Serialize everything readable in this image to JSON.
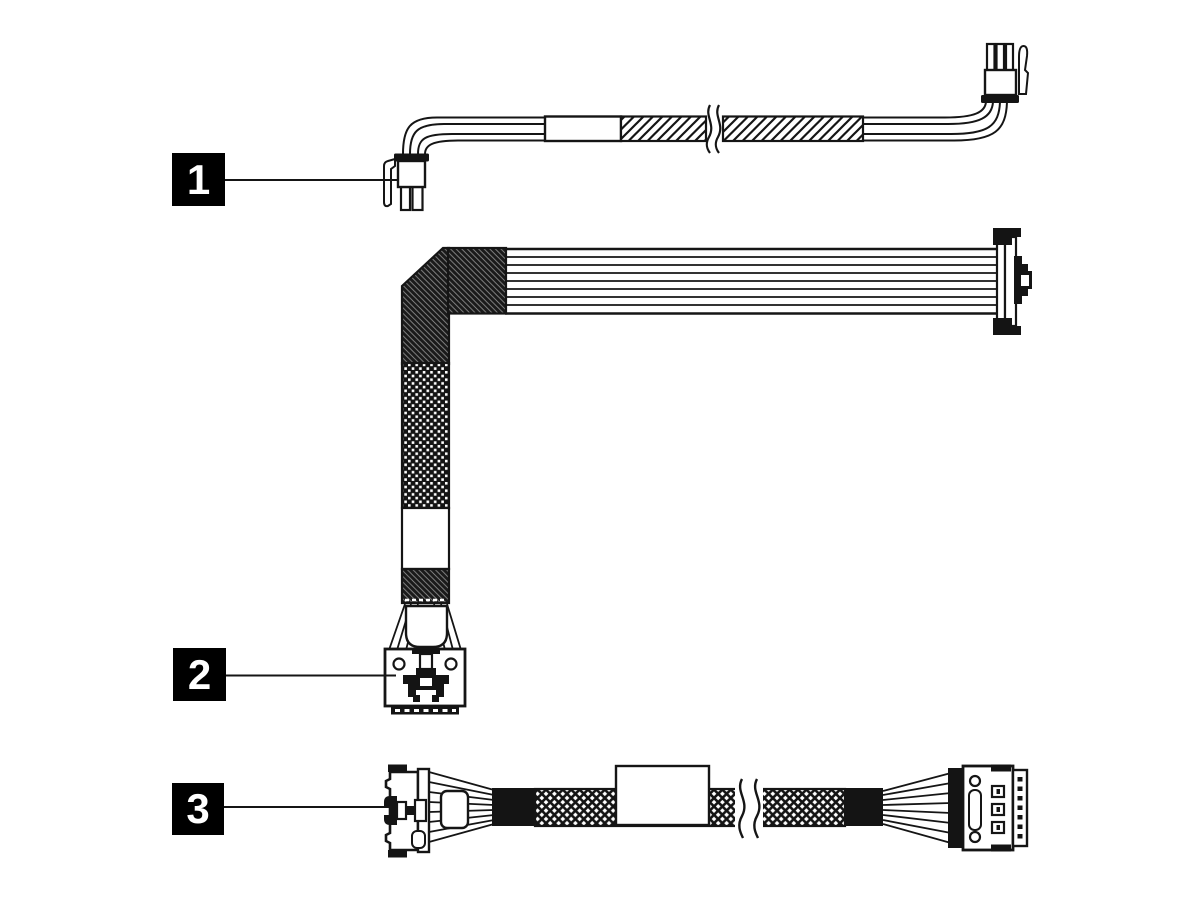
{
  "figure": {
    "type": "cable-diagram",
    "colors": {
      "paper": "#ffffff",
      "ink": "#151515",
      "callout_bg": "#000000",
      "callout_fg": "#ffffff"
    }
  },
  "callouts": [
    {
      "label": "1"
    },
    {
      "label": "2"
    },
    {
      "label": "3"
    }
  ]
}
